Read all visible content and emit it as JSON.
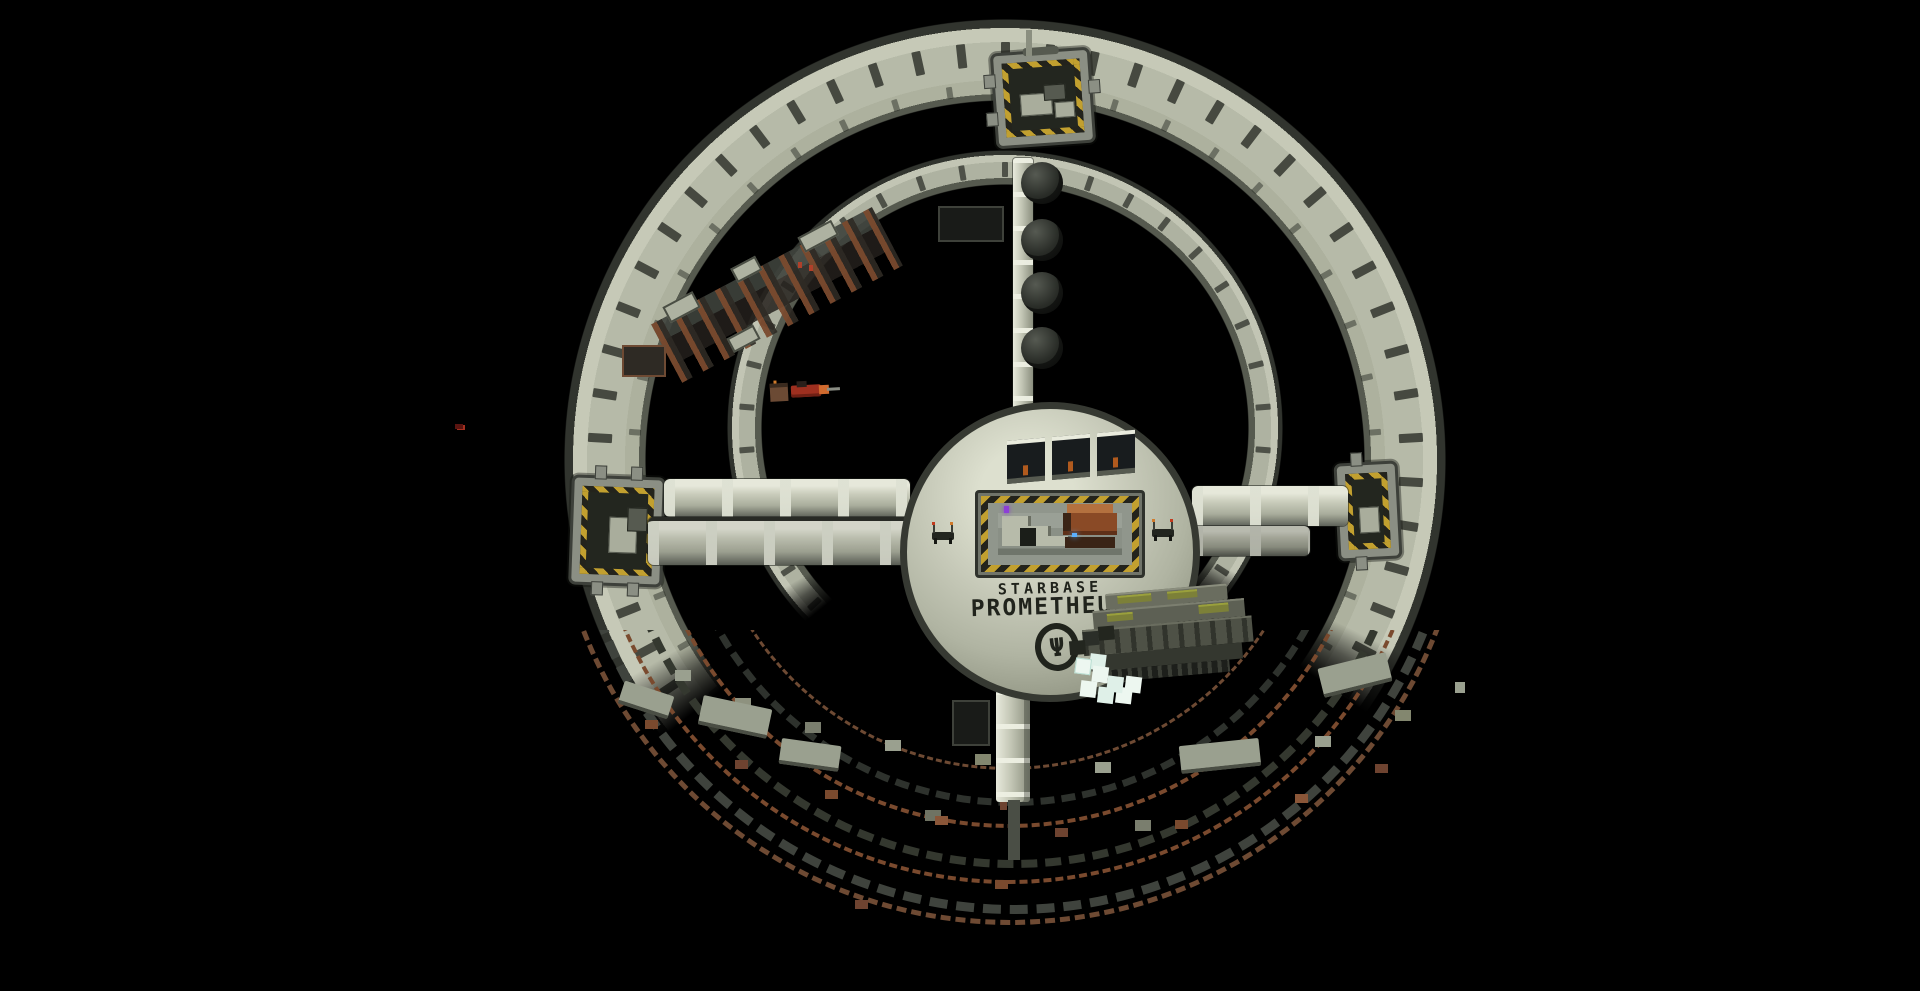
{
  "scene": {
    "description": "voxel-built circular space station floating in black space, lower ring section under construction",
    "background_color": "#000000"
  },
  "station": {
    "title_line1": "STARBASE",
    "title_line2": "PROMETHEUS",
    "emblem_glyph": "Ψ"
  },
  "palette": {
    "hull_light": "#d9dccb",
    "hull_mid": "#b6baa8",
    "hull_dark": "#7c8070",
    "frame_dark": "#2e312c",
    "hazard_yellow": "#c2a02f",
    "hazard_black": "#23231c",
    "rust_brown": "#7a4a2e",
    "scaffold_gray": "#3f433d",
    "crystal_white": "#edf7f0",
    "red_ship": "#9e2f1f",
    "orange_hauler": "#8a4a26",
    "olive_stripe": "#7c8038",
    "glow_blue": "#5ab0ff",
    "glow_purple": "#8d3fd6"
  }
}
